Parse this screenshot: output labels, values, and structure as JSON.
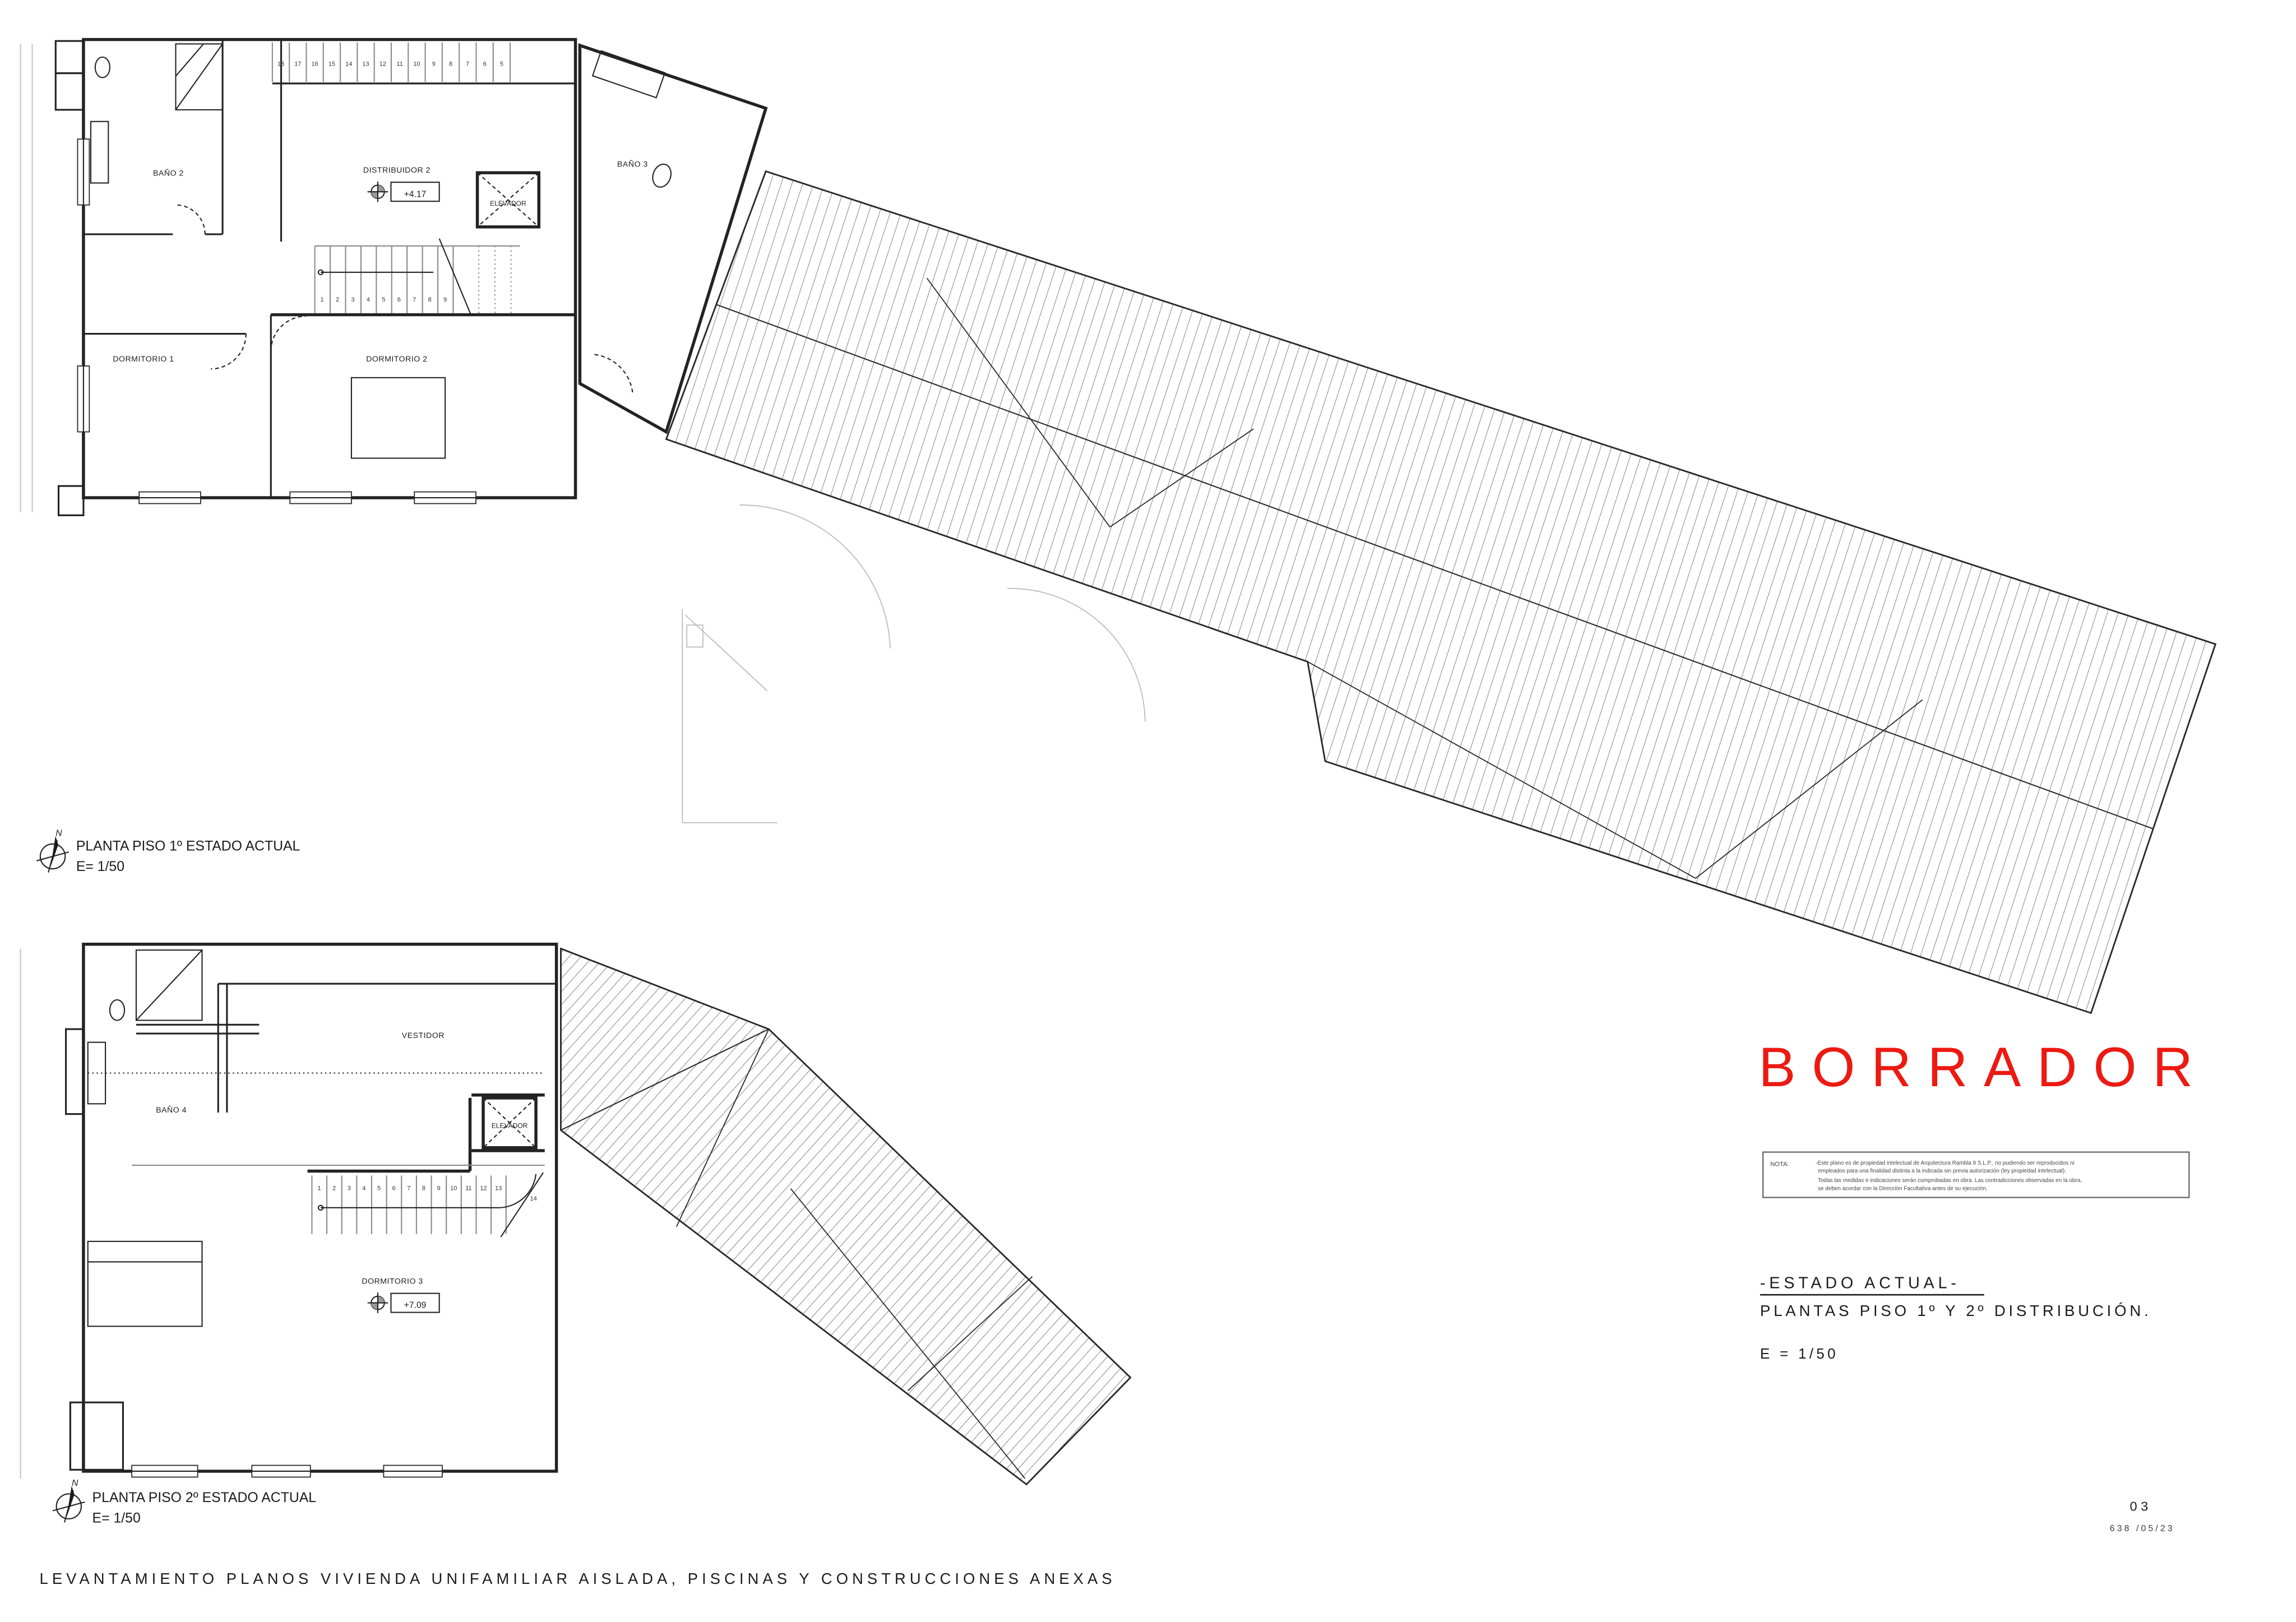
{
  "plan1": {
    "rooms": {
      "bano2": "BAÑO 2",
      "distribuidor2": "DISTRIBUIDOR 2",
      "elevador": "ELEVADOR",
      "bano3": "BAÑO 3",
      "dormitorio1": "DORMITORIO 1",
      "dormitorio2": "DORMITORIO 2"
    },
    "level_label": "+4.17",
    "stair_top": [
      "18",
      "17",
      "16",
      "15",
      "14",
      "13",
      "12",
      "11",
      "10",
      "9",
      "8",
      "7",
      "6",
      "5"
    ],
    "stair_mid": [
      "1",
      "2",
      "3",
      "4",
      "5",
      "6",
      "7",
      "8",
      "9"
    ],
    "caption_title": "PLANTA PISO 1º ESTADO ACTUAL",
    "caption_scale": "E= 1/50",
    "north_label": "N"
  },
  "plan2": {
    "rooms": {
      "vestidor": "VESTIDOR",
      "bano4": "BAÑO 4",
      "elevador": "ELEVADOR",
      "dormitorio3": "DORMITORIO 3"
    },
    "level_label": "+7.09",
    "stair": [
      "1",
      "2",
      "3",
      "4",
      "5",
      "6",
      "7",
      "8",
      "9",
      "10",
      "11",
      "12",
      "13"
    ],
    "stair_winder": "14",
    "caption_title": "PLANTA PISO 2º ESTADO ACTUAL",
    "caption_scale": "E= 1/50",
    "north_label": "N"
  },
  "titleblock": {
    "watermark": "BORRADOR",
    "watermark_color": "#ec1a12",
    "nota_label": "NOTA:",
    "nota_lines": [
      "-Este plano es de propiedad intelectual de Arquitectura Rambla 9 S.L.P., no pudiendo ser reproducidos ni",
      "empleados para una finalidad distinta a la indicada sin previa autorización (ley propiedad intelectual).",
      "Todas las medidas e indicaciones serán comprobadas en obra. Las contradicciones observadas en la obra,",
      "se deben acordar con la Dirección Facultativa antes de su ejecución."
    ],
    "status_title": "-ESTADO ACTUAL-",
    "sheet_subtitle": "PLANTAS PISO 1º Y 2º DISTRIBUCIÓN.",
    "scale_label": "E = 1/50",
    "sheet_number": "03",
    "project_code": "638 /05/23"
  },
  "footer": {
    "title": "LEVANTAMIENTO PLANOS VIVIENDA UNIFAMILIAR AISLADA, PISCINAS Y CONSTRUCCIONES ANEXAS"
  }
}
